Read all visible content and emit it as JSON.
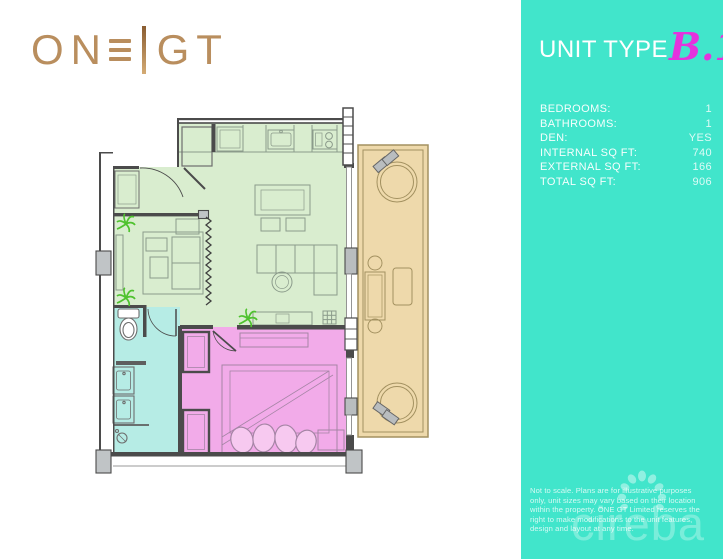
{
  "brand": {
    "logo_left": "ON",
    "logo_e": "E",
    "logo_right": "GT",
    "logo_color": "#b98e5e"
  },
  "panel": {
    "title": "UNIT TYPE",
    "unit_code": "B.1",
    "specs": [
      {
        "label": "BEDROOMS:",
        "value": "1"
      },
      {
        "label": "BATHROOMS:",
        "value": "1"
      },
      {
        "label": "DEN:",
        "value": "YES"
      },
      {
        "label": "INTERNAL SQ FT:",
        "value": "740"
      },
      {
        "label": "EXTERNAL SQ FT:",
        "value": "166"
      },
      {
        "label": "TOTAL SQ FT:",
        "value": "906"
      }
    ],
    "disclaimer": "Not to scale. Plans are for illustrative purposes only, unit sizes may vary based on their location within the property. ONE GT Limited reserves the right to make modifications to the unit features, design and layout at any time.",
    "watermark": "cireba",
    "colors": {
      "panel_bg": "#41e5cb",
      "unit_code": "#e433dd"
    }
  },
  "floorplan": {
    "wall_color": "#4b4b4b",
    "rooms": [
      {
        "name": "living-dining-kitchen",
        "color": "#d9edcf"
      },
      {
        "name": "entry-den",
        "color": "#d9edcf"
      },
      {
        "name": "bathroom",
        "color": "#b6ece5"
      },
      {
        "name": "bedroom",
        "color": "#f2abe9"
      },
      {
        "name": "balcony",
        "color": "#eed9ab"
      }
    ]
  }
}
